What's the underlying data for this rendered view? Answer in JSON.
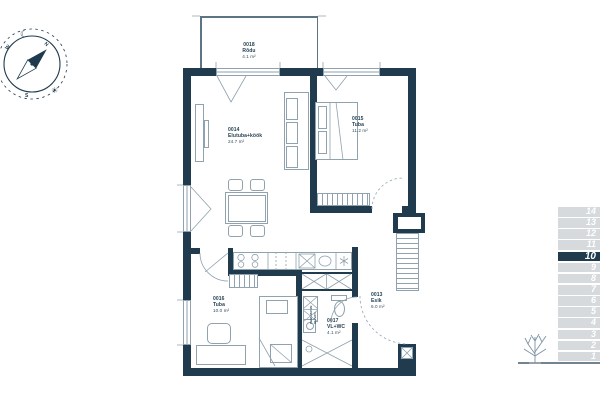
{
  "palette": {
    "wall": "#1f3b4d",
    "furniture_line": "#8fa2ad",
    "floor_row_bg": "#d6dadd",
    "floor_row_number": "#ffffff",
    "selected_floor_bg": "#1f3b4d",
    "tree": "#7d93a3"
  },
  "compass": {
    "north": "N",
    "west": "W",
    "south": "S",
    "moon": "☾",
    "sun": "☀"
  },
  "rooms": {
    "balcony": {
      "id": "0018",
      "name": "Rõdu",
      "area": "4.1 m²"
    },
    "living": {
      "id": "0014",
      "name": "Elutuba+köök",
      "area": "24.7 m²"
    },
    "bedroom": {
      "id": "0015",
      "name": "Tuba",
      "area": "11.2 m²"
    },
    "bedroom2": {
      "id": "0016",
      "name": "Tuba",
      "area": "10.0 m²"
    },
    "bathroom": {
      "id": "0017",
      "name": "VL+WC",
      "area": "4.1 m²"
    },
    "hallway": {
      "id": "0013",
      "name": "Esik",
      "area": "6.0 m²"
    }
  },
  "bathroom_appliances": {
    "washer": "PESUMASIN",
    "dryer": "KUIVATI"
  },
  "floor_selector": {
    "selected": "10",
    "floors": [
      "14",
      "13",
      "12",
      "11",
      "10",
      "9",
      "8",
      "7",
      "6",
      "5",
      "4",
      "3",
      "2",
      "1"
    ]
  }
}
